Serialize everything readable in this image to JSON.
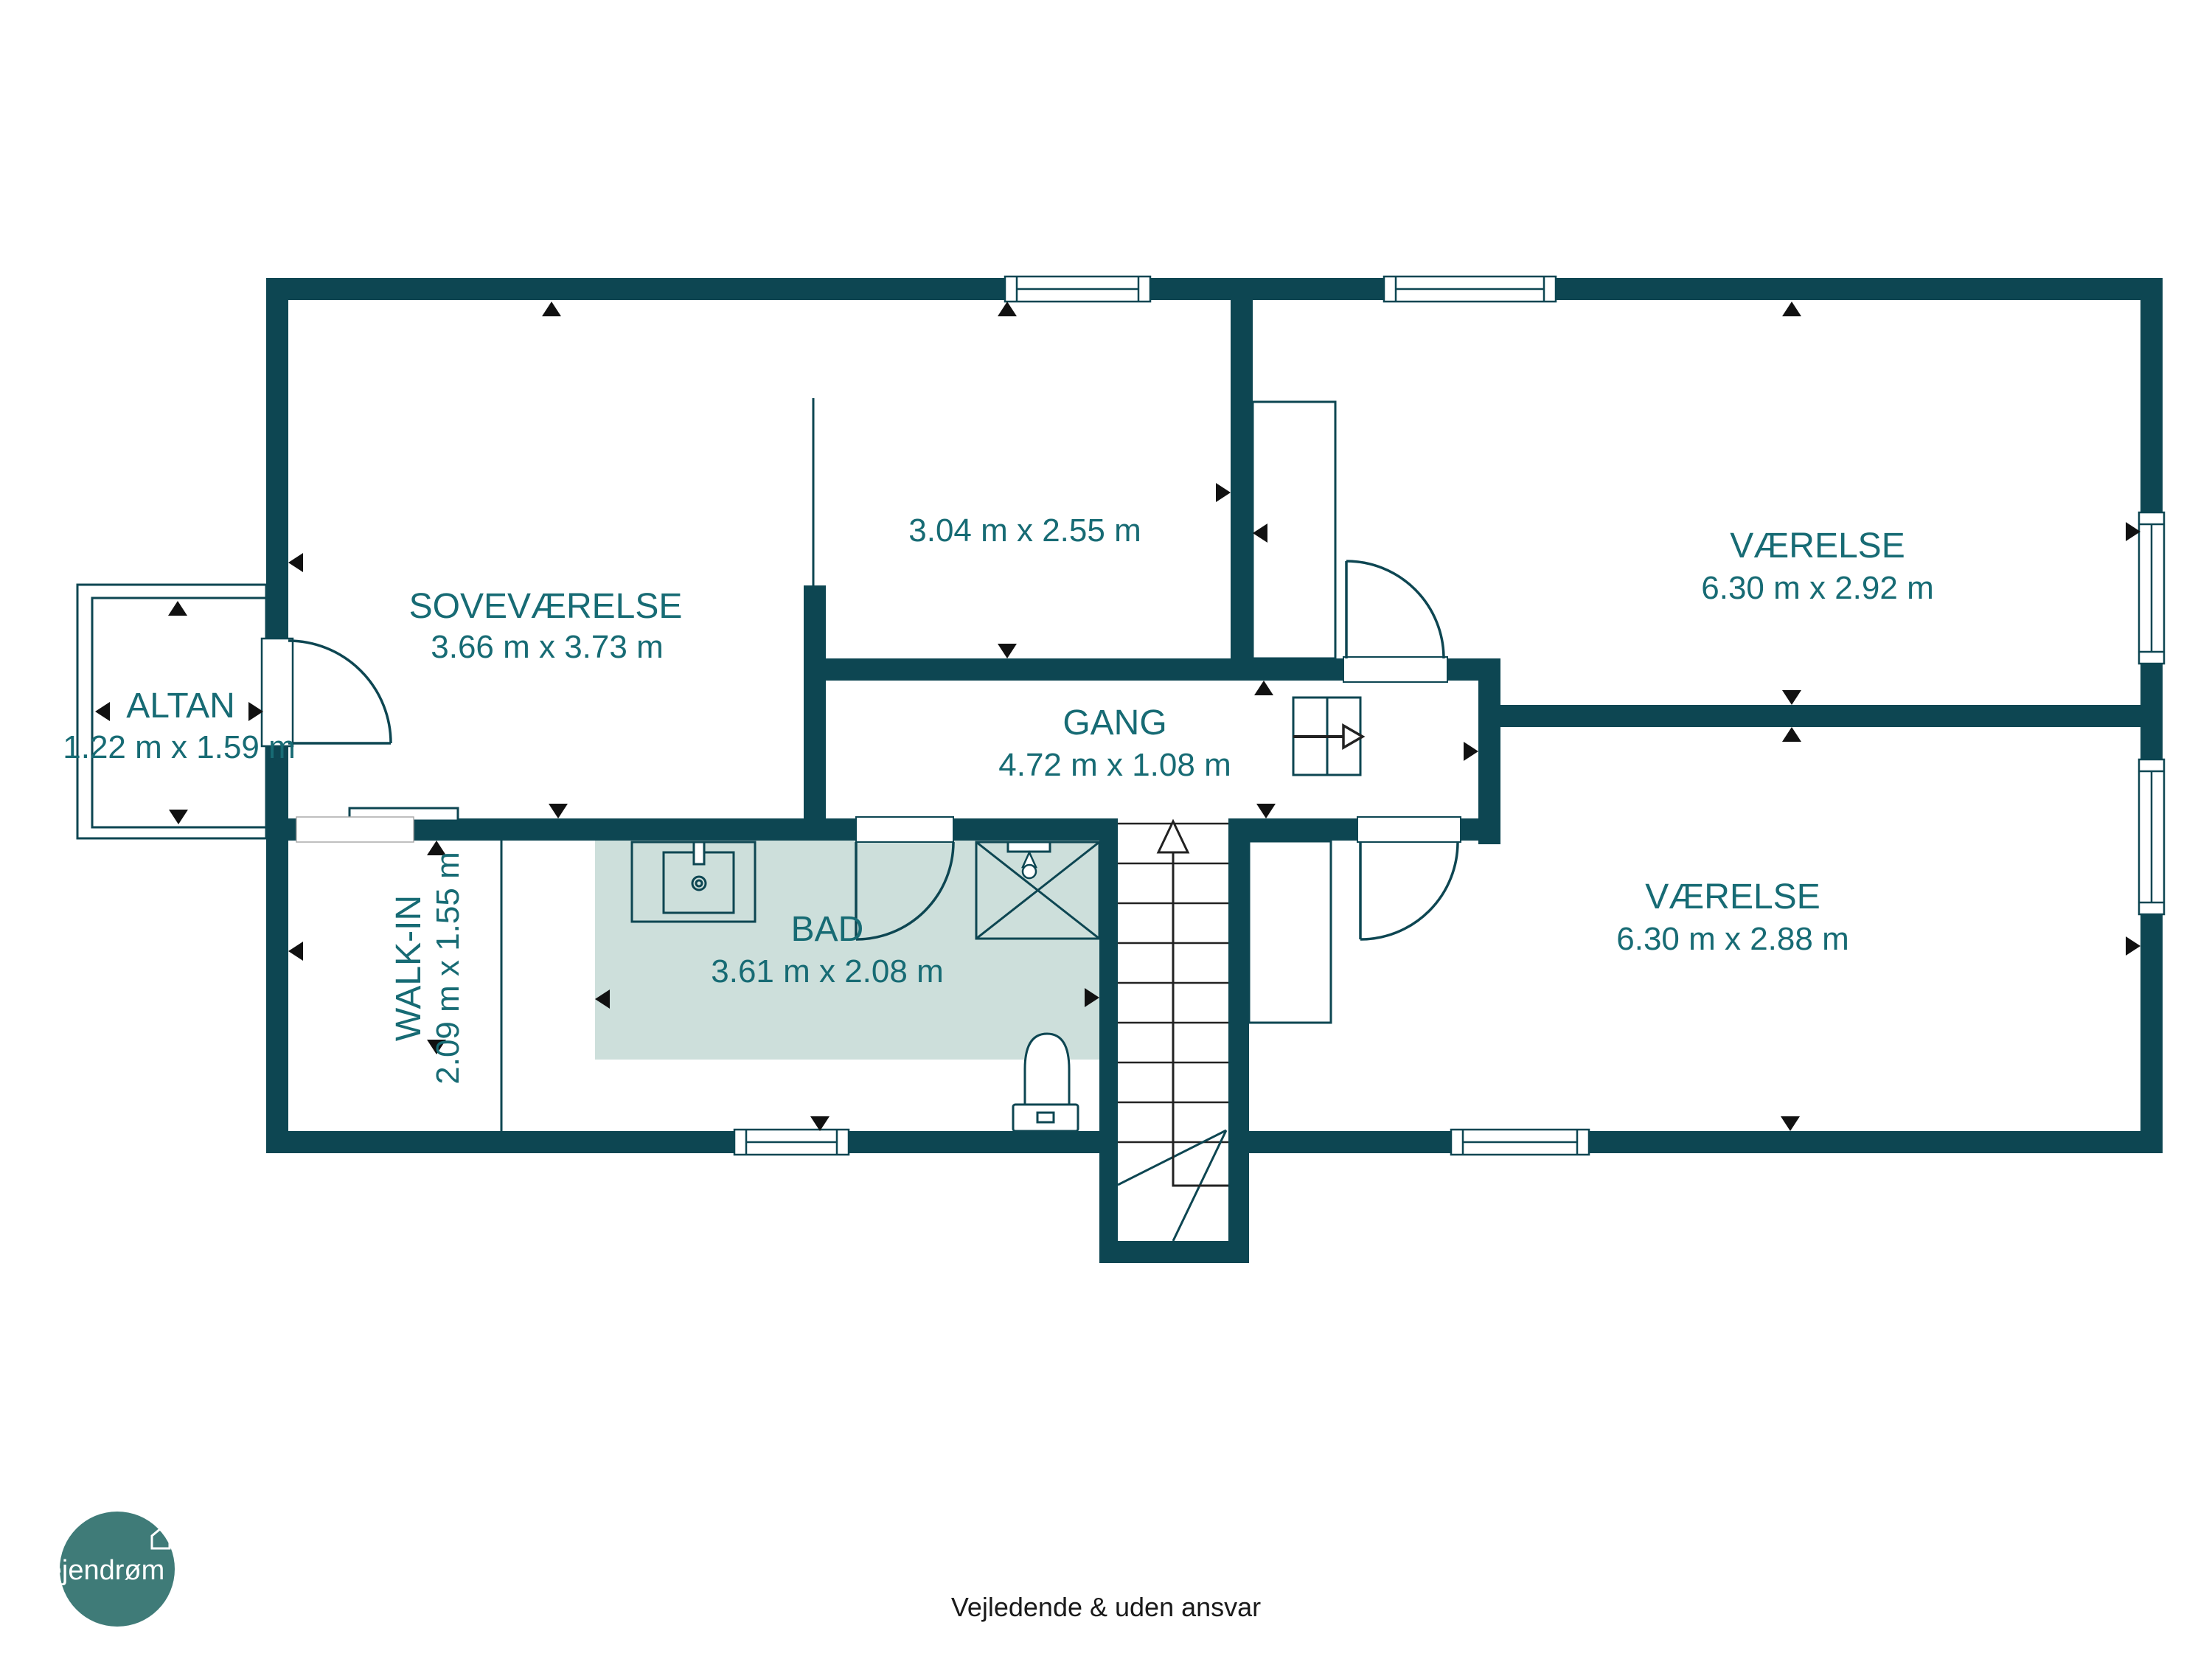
{
  "plan": {
    "rooms": {
      "sovevaerelse": {
        "name": "SOVEVÆRELSE",
        "dims": "3.66 m x 3.73 m"
      },
      "room_small": {
        "name": "",
        "dims": "3.04 m x 2.55 m"
      },
      "vaerelse_top": {
        "name": "VÆRELSE",
        "dims": "6.30 m x 2.92 m"
      },
      "gang": {
        "name": "GANG",
        "dims": "4.72 m x 1.08 m"
      },
      "vaerelse_bottom": {
        "name": "VÆRELSE",
        "dims": "6.30 m x 2.88 m"
      },
      "bad": {
        "name": "BAD",
        "dims": "3.61 m x 2.08 m"
      },
      "walk_in": {
        "name": "WALK-IN",
        "dims": "2.09 m x 1.55 m"
      },
      "altan": {
        "name": "ALTAN",
        "dims": "1.22 m x 1.59 m"
      }
    },
    "colors": {
      "wall": "#0d4652",
      "room_label": "#176b74",
      "bath_floor": "#cddfdb",
      "logo_circle": "#3f7b78"
    }
  },
  "logo": {
    "text": "ejendrøm"
  },
  "footer": {
    "disclaimer": "Vejledende & uden ansvar"
  }
}
